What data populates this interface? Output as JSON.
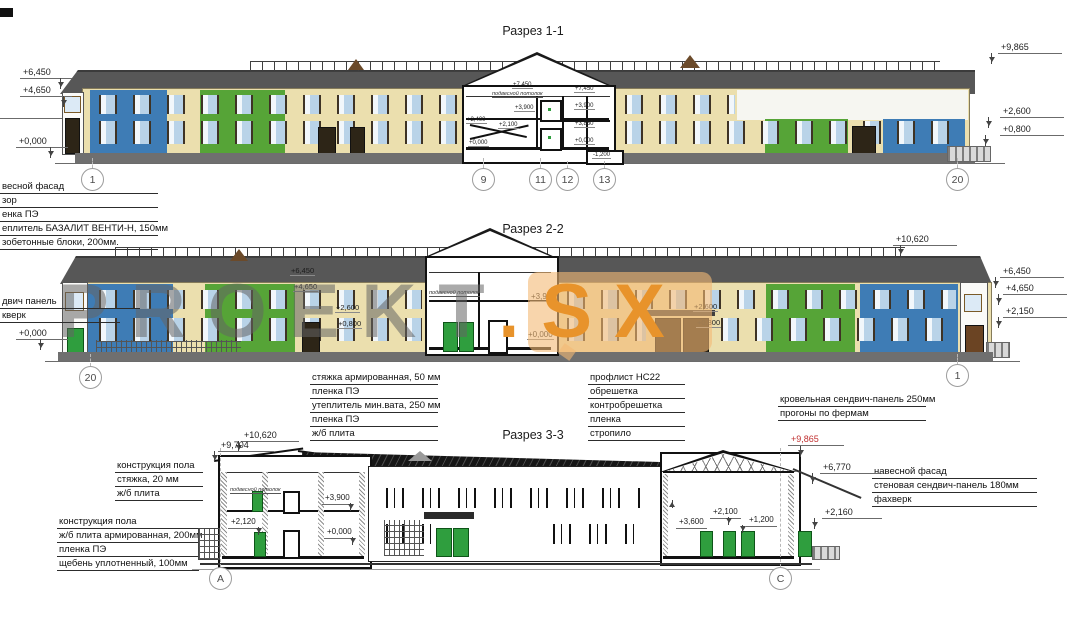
{
  "wm": {
    "text": "PROEKT",
    "suffix": ".SX"
  },
  "colors": {
    "facade_beige": "#EBDFAE",
    "panel_blue": "#3E7CB5",
    "panel_green": "#56A437",
    "roof_gray": "#575757",
    "door_green": "#2F9E3E",
    "mark_red": "#C03030",
    "watermark_orange": "#E8932B"
  },
  "s1": {
    "title": "Разрез 1-1",
    "dims_left": [
      "+6,450",
      "+4,650",
      "+0,000"
    ],
    "dims_right": [
      "+9,865",
      "+2,600",
      "+0,800"
    ],
    "cut": {
      "ceiling": "подвесной потолок",
      "a": "+7,450",
      "b": "+3,900",
      "c": "+2,100",
      "d": "+2,400",
      "e": "+0,000",
      "f": "+7,450",
      "g": "+3,900",
      "h": "+3,850",
      "i": "+0,000",
      "pit": "-1,200"
    },
    "axes": [
      "1",
      "9",
      "11",
      "12",
      "13",
      "20"
    ],
    "legend": [
      "весной фасад",
      "зор",
      "енка ПЭ",
      "еплитель БАЗАЛИТ ВЕНТИ-Н, 150мм",
      "зобетонные блоки, 200мм."
    ]
  },
  "s2": {
    "title": "Разрез 2-2",
    "dim_top": "+10,620",
    "dims_right": [
      "+6,450",
      "+4,650",
      "+2,150"
    ],
    "dim_zero": "+0,000",
    "facade_left": [
      "+6,450",
      "+4,650",
      "+2,600",
      "+0,800"
    ],
    "facade_right": [
      "+2,600",
      "+0,800"
    ],
    "cut": {
      "ceiling": "подвесной потолок",
      "a": "+3,900",
      "b": "+0,000"
    },
    "axes": [
      "20",
      "1"
    ],
    "legend": [
      "двич панель",
      "кверк"
    ]
  },
  "s3": {
    "title": "Разрез 3-3",
    "dims_top": [
      "+10,620",
      "+9,704"
    ],
    "cut_left": {
      "ceiling": "подвесной потолок",
      "a": "+3,900",
      "b": "+2,120",
      "c": "+0,000"
    },
    "dim_red": "+9,865",
    "dims_right": [
      "+6,770",
      "+2,160"
    ],
    "hall": [
      "+3,600",
      "+2,100",
      "+1,200"
    ],
    "axes": [
      "А",
      "С"
    ],
    "legend_roof_slab": [
      "стяжка армированная, 50 мм",
      "пленка ПЭ",
      "утеплитель мин.вата, 250 мм",
      "пленка ПЭ",
      "ж/б плита"
    ],
    "legend_roof": [
      "профлист НС22",
      "обрешетка",
      "контробрешетка",
      "пленка",
      "стропило"
    ],
    "legend_roof_panel": [
      "кровельная сендвич-панель 250мм",
      "прогоны по фермам"
    ],
    "legend_floor_upper": [
      "конструкция пола",
      "стяжка, 20 мм",
      "ж/б плита"
    ],
    "legend_floor_ground": [
      "конструкция пола",
      "ж/б плита армированная, 200мм",
      "пленка ПЭ",
      "щебень уплотненный, 100мм"
    ],
    "legend_wall_right": [
      "навесной фасад",
      "стеновая сендвич-панель 180мм",
      "фахверк"
    ]
  }
}
